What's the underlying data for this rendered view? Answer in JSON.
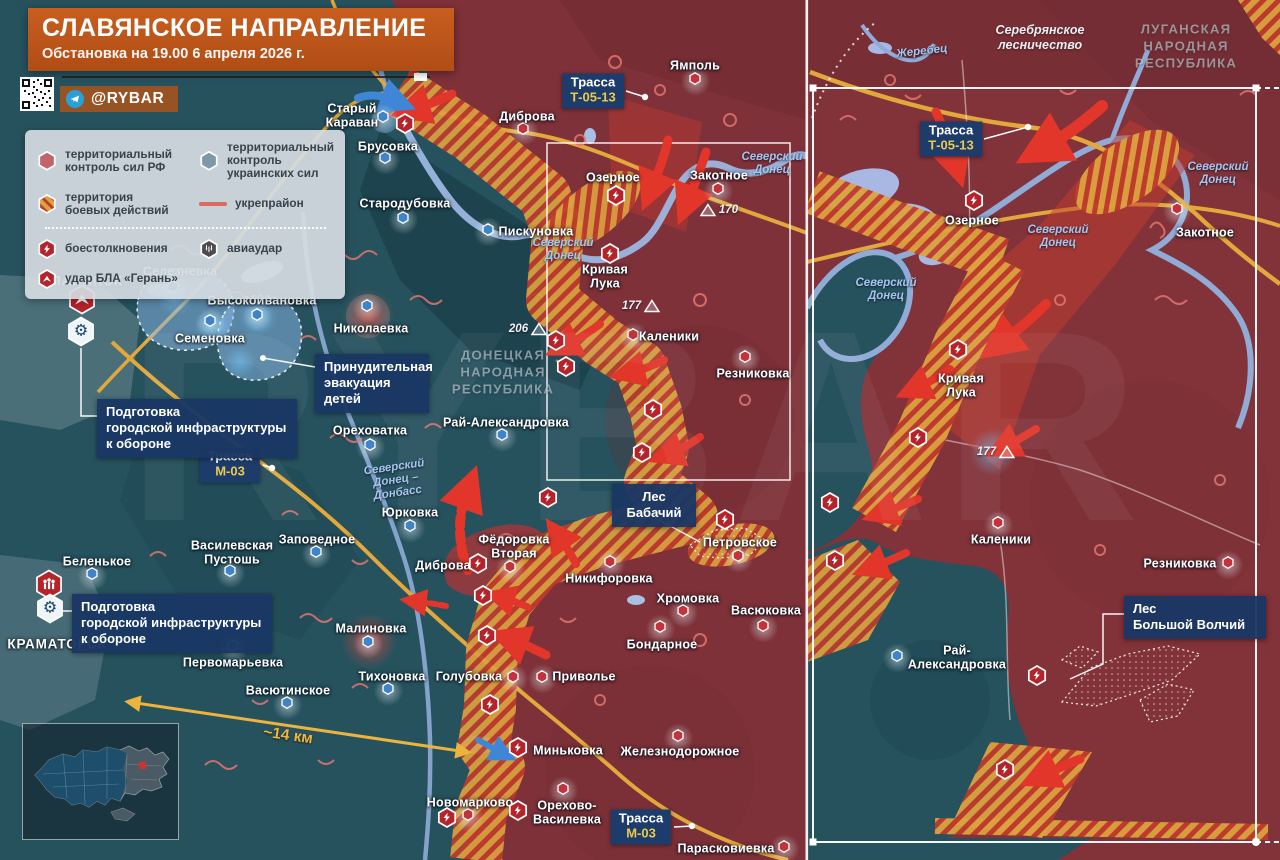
{
  "header": {
    "title": "СЛАВЯНСКОЕ НАПРАВЛЕНИЕ",
    "subtitle": "Обстановка на 19.00 6 апреля 2026 г.",
    "channel": "@RYBAR"
  },
  "watermark": "RYBAR",
  "legend": {
    "territory": [
      {
        "icon": "hex-red",
        "label": "территориальный\nконтроль сил РФ"
      },
      {
        "icon": "hex-blue",
        "label": "территориальный\nконтроль украинских сил"
      },
      {
        "icon": "hex-striped",
        "label": "территория\nбоевых действий"
      },
      {
        "icon": "line-red",
        "label": "укрепрайон"
      }
    ],
    "events": [
      {
        "icon": "clash",
        "label": "боестолкновения"
      },
      {
        "icon": "airstrike",
        "label": "авиаудар"
      },
      {
        "icon": "drone",
        "label": "удар БЛА «Герань»"
      }
    ]
  },
  "regions": [
    {
      "text": "ДОНЕЦКАЯ\nНАРОДНАЯ\nРЕСПУБЛИКА",
      "x": 503,
      "y": 372
    },
    {
      "text": "ЛУГАНСКАЯ\nНАРОДНАЯ\nРЕСПУБЛИКА",
      "x": 1186,
      "y": 46
    }
  ],
  "notes": [
    {
      "text": "Серебрянское\nлесничество",
      "x": 1040,
      "y": 38
    }
  ],
  "rivers": [
    {
      "text": "Северский\nДонец",
      "x": 563,
      "y": 250,
      "rot": 0
    },
    {
      "text": "Северский\nДонец",
      "x": 772,
      "y": 164,
      "rot": 0
    },
    {
      "text": "Северский\nДонец –\nДонбасс",
      "x": 396,
      "y": 481,
      "rot": -8
    },
    {
      "text": "Жеребец",
      "x": 922,
      "y": 52,
      "rot": -6
    },
    {
      "text": "Северский\nДонец",
      "x": 1218,
      "y": 174,
      "rot": 0
    },
    {
      "text": "Северский\nДонец",
      "x": 1058,
      "y": 237,
      "rot": 0
    },
    {
      "text": "Северский\nДонец",
      "x": 886,
      "y": 290,
      "rot": 0
    }
  ],
  "roads": [
    {
      "name": "Трасса",
      "number": "Т-05-13",
      "x": 593,
      "y": 91,
      "dot": [
        645,
        97
      ]
    },
    {
      "name": "Трасса",
      "number": "Т-05-13",
      "x": 951,
      "y": 139,
      "dot": [
        1028,
        127
      ]
    },
    {
      "name": "Трасса",
      "number": "М-03",
      "x": 230,
      "y": 465,
      "dot": [
        272,
        468
      ]
    },
    {
      "name": "Трасса",
      "number": "М-03",
      "x": 641,
      "y": 827,
      "dot": [
        692,
        826
      ]
    }
  ],
  "callouts": [
    {
      "text": "Принудительная\nэвакуация\nдетей",
      "x": 315,
      "y": 354,
      "w": 96,
      "center": false
    },
    {
      "text": "Подготовка\nгородской инфраструктуры\nк обороне",
      "x": 97,
      "y": 399,
      "w": 182,
      "center": false
    },
    {
      "text": "Подготовка\nгородской инфраструктуры\nк обороне",
      "x": 72,
      "y": 594,
      "w": 182,
      "center": false
    },
    {
      "text": "Лес\nБабачий",
      "x": 612,
      "y": 484,
      "w": 66,
      "center": true
    },
    {
      "text": "Лес\nБольшой Волчий",
      "x": 1124,
      "y": 596,
      "w": 124,
      "center": false
    }
  ],
  "distance": {
    "text": "~14 км",
    "x": 288,
    "y": 736
  },
  "heights": [
    {
      "value": "170",
      "x": 719,
      "y": 210,
      "side": "r"
    },
    {
      "value": "177",
      "x": 641,
      "y": 306,
      "side": "l"
    },
    {
      "value": "206",
      "x": 528,
      "y": 329,
      "side": "l"
    },
    {
      "value": "177",
      "x": 996,
      "y": 452,
      "side": "l"
    }
  ],
  "icons": [
    {
      "type": "clash",
      "x": 405,
      "y": 126
    },
    {
      "type": "clash",
      "x": 616,
      "y": 198
    },
    {
      "type": "clash",
      "x": 610,
      "y": 256
    },
    {
      "type": "clash",
      "x": 556,
      "y": 343
    },
    {
      "type": "clash",
      "x": 566,
      "y": 369
    },
    {
      "type": "clash",
      "x": 653,
      "y": 412
    },
    {
      "type": "clash",
      "x": 642,
      "y": 455
    },
    {
      "type": "clash",
      "x": 548,
      "y": 500
    },
    {
      "type": "clash",
      "x": 725,
      "y": 522
    },
    {
      "type": "clash",
      "x": 478,
      "y": 566
    },
    {
      "type": "clash",
      "x": 483,
      "y": 598
    },
    {
      "type": "clash",
      "x": 487,
      "y": 638
    },
    {
      "type": "clash",
      "x": 490,
      "y": 707
    },
    {
      "type": "clash",
      "x": 518,
      "y": 750
    },
    {
      "type": "clash",
      "x": 447,
      "y": 820
    },
    {
      "type": "clash",
      "x": 518,
      "y": 813
    },
    {
      "type": "drone",
      "x": 82,
      "y": 302
    },
    {
      "type": "gear",
      "x": 81,
      "y": 334
    },
    {
      "type": "people",
      "x": 49,
      "y": 587
    },
    {
      "type": "gear",
      "x": 50,
      "y": 611
    },
    {
      "type": "clash",
      "x": 974,
      "y": 203
    },
    {
      "type": "clash",
      "x": 958,
      "y": 352
    },
    {
      "type": "clash",
      "x": 918,
      "y": 440
    },
    {
      "type": "clash",
      "x": 830,
      "y": 505
    },
    {
      "type": "clash",
      "x": 835,
      "y": 563
    },
    {
      "type": "clash",
      "x": 1037,
      "y": 678
    },
    {
      "type": "clash",
      "x": 1005,
      "y": 772
    }
  ],
  "cities": [
    {
      "name": "Старый\nКараван",
      "x": 352,
      "y": 116,
      "marker": [
        383,
        119
      ],
      "side": "ua"
    },
    {
      "name": "Брусовка",
      "x": 388,
      "y": 147,
      "marker": [
        385,
        160
      ],
      "side": "ua"
    },
    {
      "name": "Стародубовка",
      "x": 405,
      "y": 204,
      "marker": [
        403,
        220
      ],
      "side": "ua"
    },
    {
      "name": "Пискуновка",
      "x": 536,
      "y": 232,
      "marker": [
        488,
        232
      ],
      "side": "ua"
    },
    {
      "name": "Селезневка",
      "x": 180,
      "y": 272,
      "marker": [
        173,
        289
      ],
      "side": "ua"
    },
    {
      "name": "Высокоивановка",
      "x": 262,
      "y": 301,
      "marker": [
        257,
        317
      ],
      "side": "ua"
    },
    {
      "name": "Семеновка",
      "x": 210,
      "y": 339,
      "marker": [
        210,
        323
      ],
      "side": "ua"
    },
    {
      "name": "Николаевка",
      "x": 371,
      "y": 329,
      "marker": [
        367,
        308
      ],
      "side": "ua"
    },
    {
      "name": "Ореховатка",
      "x": 370,
      "y": 431,
      "marker": [
        370,
        447
      ],
      "side": "ua"
    },
    {
      "name": "Рай-Александровка",
      "x": 506,
      "y": 423,
      "marker": [
        502,
        437
      ],
      "side": "ua"
    },
    {
      "name": "Юрковка",
      "x": 410,
      "y": 513,
      "marker": [
        410,
        528
      ],
      "side": "ua"
    },
    {
      "name": "Заповедное",
      "x": 317,
      "y": 540,
      "marker": [
        316,
        554
      ],
      "side": "ua"
    },
    {
      "name": "Василевская\nПустошь",
      "x": 232,
      "y": 553,
      "marker": [
        230,
        573
      ],
      "side": "ua"
    },
    {
      "name": "Беленькое",
      "x": 97,
      "y": 562,
      "marker": [
        92,
        576
      ],
      "side": "ua"
    },
    {
      "name": "Первомарьевка",
      "x": 233,
      "y": 663,
      "marker": [
        233,
        648
      ],
      "side": "ua"
    },
    {
      "name": "Малиновка",
      "x": 371,
      "y": 629,
      "marker": [
        368,
        644
      ],
      "side": "ua"
    },
    {
      "name": "Тихоновка",
      "x": 392,
      "y": 677,
      "marker": [
        388,
        691
      ],
      "side": "ua"
    },
    {
      "name": "Васютинское",
      "x": 288,
      "y": 691,
      "marker": [
        287,
        705
      ],
      "side": "ua"
    },
    {
      "name": "Диброва",
      "x": 443,
      "y": 566,
      "marker": null,
      "side": "ua"
    },
    {
      "name": "СЛАВЯНСК",
      "x": 82,
      "y": 282,
      "marker": null,
      "side": "ua",
      "caps": true
    },
    {
      "name": "КРАМАТОРСК",
      "x": 57,
      "y": 645,
      "marker": null,
      "side": "ua",
      "caps": true
    },
    {
      "name": "Голубовка",
      "x": 469,
      "y": 677,
      "marker": [
        513,
        679
      ],
      "side": "ru"
    },
    {
      "name": "Приволье",
      "x": 584,
      "y": 677,
      "marker": [
        542,
        679
      ],
      "side": "ru"
    },
    {
      "name": "Никифоровка",
      "x": 609,
      "y": 579,
      "marker": [
        610,
        564
      ],
      "side": "ru"
    },
    {
      "name": "Хромовка",
      "x": 688,
      "y": 599,
      "marker": [
        683,
        613
      ],
      "side": "ru"
    },
    {
      "name": "Васюковка",
      "x": 766,
      "y": 611,
      "marker": [
        763,
        628
      ],
      "side": "ru"
    },
    {
      "name": "Бондарное",
      "x": 662,
      "y": 645,
      "marker": [
        660,
        629
      ],
      "side": "ru"
    },
    {
      "name": "Миньковка",
      "x": 568,
      "y": 751,
      "marker": null,
      "side": "ru"
    },
    {
      "name": "Железнодорожное",
      "x": 680,
      "y": 752,
      "marker": [
        678,
        738
      ],
      "side": "ru"
    },
    {
      "name": "Новомарково",
      "x": 470,
      "y": 803,
      "marker": [
        468,
        817
      ],
      "side": "ru"
    },
    {
      "name": "Орехово-\nВасилевка",
      "x": 567,
      "y": 813,
      "marker": [
        563,
        791
      ],
      "side": "ru"
    },
    {
      "name": "Парасковиевка",
      "x": 726,
      "y": 849,
      "marker": [
        784,
        849
      ],
      "side": "ru"
    },
    {
      "name": "Ямполь",
      "x": 695,
      "y": 66,
      "marker": [
        695,
        81
      ],
      "side": "ru"
    },
    {
      "name": "Диброва",
      "x": 527,
      "y": 117,
      "marker": [
        523,
        131
      ],
      "side": "ru"
    },
    {
      "name": "Озерное",
      "x": 613,
      "y": 178,
      "marker": null,
      "side": "ru"
    },
    {
      "name": "Закотное",
      "x": 719,
      "y": 176,
      "marker": [
        718,
        191
      ],
      "side": "ru"
    },
    {
      "name": "Кривая\nЛука",
      "x": 605,
      "y": 277,
      "marker": null,
      "side": "ru"
    },
    {
      "name": "Каленики",
      "x": 669,
      "y": 337,
      "marker": [
        633,
        337
      ],
      "side": "ru"
    },
    {
      "name": "Резниковка",
      "x": 753,
      "y": 374,
      "marker": [
        745,
        359
      ],
      "side": "ru"
    },
    {
      "name": "Фёдоровка\nВторая",
      "x": 514,
      "y": 547,
      "marker": [
        510,
        569
      ],
      "side": "ru"
    },
    {
      "name": "Петровское",
      "x": 740,
      "y": 543,
      "marker": [
        738,
        558
      ],
      "side": "ru"
    },
    {
      "name": "Озерное",
      "x": 972,
      "y": 221,
      "marker": null,
      "side": "ru"
    },
    {
      "name": "Закотное",
      "x": 1205,
      "y": 233,
      "marker": [
        1177,
        211
      ],
      "side": "ru"
    },
    {
      "name": "Кривая\nЛука",
      "x": 961,
      "y": 386,
      "marker": null,
      "side": "ru"
    },
    {
      "name": "Каленики",
      "x": 1001,
      "y": 540,
      "marker": [
        998,
        525
      ],
      "side": "ru"
    },
    {
      "name": "Резниковка",
      "x": 1180,
      "y": 564,
      "marker": [
        1228,
        565
      ],
      "side": "ru"
    },
    {
      "name": "Рай-\nАлександровка",
      "x": 957,
      "y": 658,
      "marker": [
        897,
        658
      ],
      "side": "ua"
    }
  ]
}
